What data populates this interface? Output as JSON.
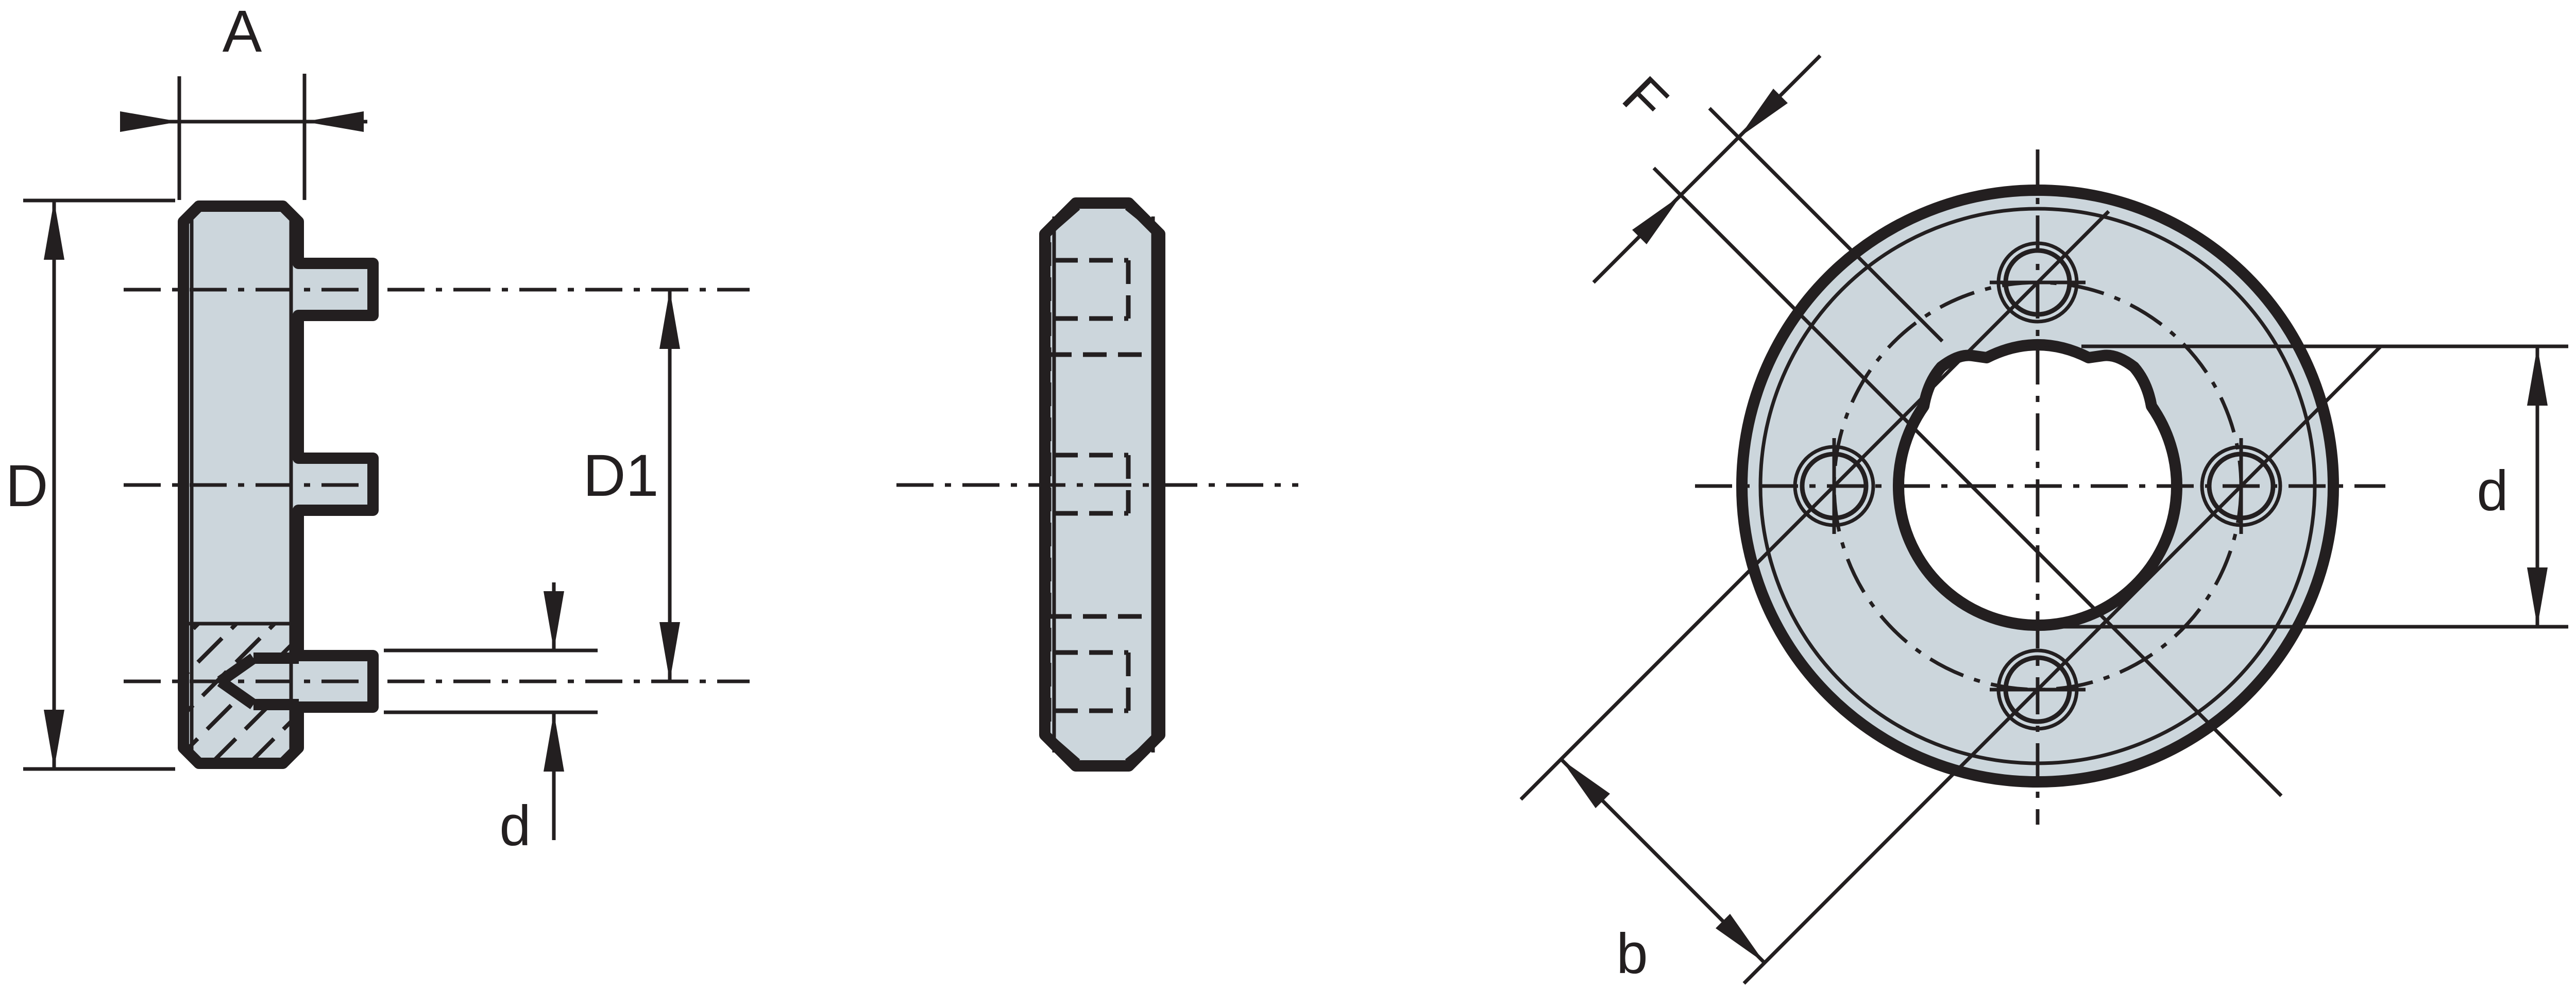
{
  "drawing": {
    "title": "flange-drive-washer-three-view-technical-drawing",
    "views": [
      {
        "id": "side-section-view",
        "description": "left sectioned side view with three drive pins"
      },
      {
        "id": "profile-view",
        "description": "middle profile view with hidden lines"
      },
      {
        "id": "front-view",
        "description": "right front view, flange with 4 holes and notched bore"
      }
    ],
    "labels": {
      "width": "A",
      "outer_diameter": "D",
      "pin_circle_diameter": "D1",
      "pin_diameter_side": "d",
      "notch_dim": "F",
      "bore_diameter_front": "d",
      "hole_chord_spacing": "b"
    },
    "colors": {
      "line": "#231f20",
      "fill": "#ccd6dc",
      "background": "#ffffff"
    }
  }
}
